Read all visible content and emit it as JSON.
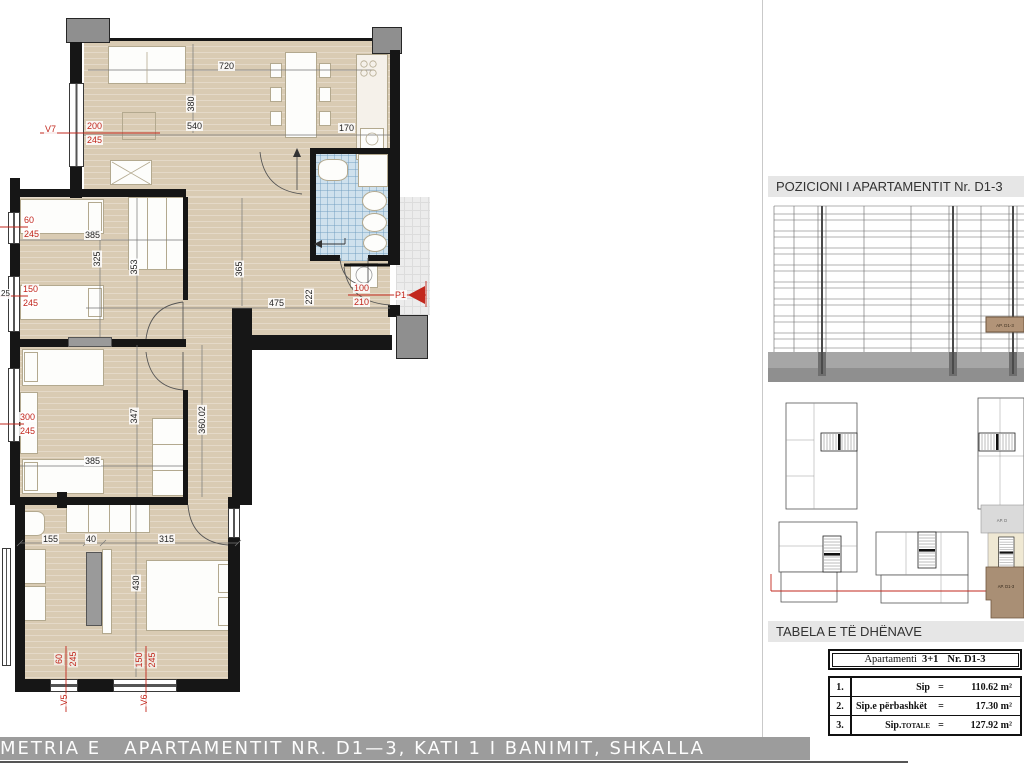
{
  "colors": {
    "accent_red": "#c2271d",
    "floor_beige": "#d9cbb3",
    "bath_blue": "#cfe1ed",
    "wall_black": "#161616",
    "column_gray": "#8f8f8f",
    "highlight_brown": "#b29478"
  },
  "plan": {
    "windows": {
      "v7": {
        "label": "V7",
        "w": "200",
        "h": "245"
      },
      "bedroom1_top": {
        "w": "60",
        "h": "245"
      },
      "bedroom1_bottom": {
        "w": "150",
        "h": "245"
      },
      "bedroom2": {
        "w": "300",
        "h": "245"
      },
      "v5": {
        "label": "V5",
        "w": "60",
        "h": "245"
      },
      "v6": {
        "label": "V6",
        "w": "150",
        "h": "245"
      }
    },
    "entrance": {
      "label": "P1",
      "w": "100",
      "h": "210"
    },
    "dims": {
      "living_width": "720",
      "living_depth": "380",
      "living_inner": "540",
      "kitchen": "170",
      "bedroom1_width": "385",
      "bedroom1_depth1": "325",
      "bedroom1_depth2": "353",
      "hall_depth": "365",
      "hall_width": "475",
      "hall_jog": "222",
      "wall_thickness": "25",
      "bedroom2_depth": "347",
      "bedroom2_width": "385",
      "corridor_length": "360.02",
      "master_seg1": "155",
      "master_seg2": "40",
      "master_seg3": "315",
      "master_depth": "430"
    }
  },
  "right_panel": {
    "position_title": "POZICIONI I APARTAMENTIT Nr. D1-3",
    "elevation_tag": "AP. D1-3",
    "site_labels": {
      "gray": "AP. D",
      "brown": "AP. D1-3"
    },
    "table_title": "TABELA E TË DHËNAVE",
    "table": {
      "header": {
        "word": "Apartamenti",
        "type": "3+1",
        "number": "Nr. D1-3"
      },
      "rows": [
        {
          "n": "1.",
          "label": "Sip",
          "sub": "",
          "eq": "=",
          "val": "110.62 m²"
        },
        {
          "n": "2.",
          "label": "Sip.e përbashkët",
          "sub": "",
          "eq": "=",
          "val": "17.30 m²"
        },
        {
          "n": "3.",
          "label": "Sip.",
          "sub": "TOTALE",
          "eq": "=",
          "val": "127.92 m²"
        }
      ]
    }
  },
  "footer": {
    "title": "METRIA E   APARTAMENTIT NR. D1—3, KATI 1 I BANIMIT, SHKALLA"
  }
}
